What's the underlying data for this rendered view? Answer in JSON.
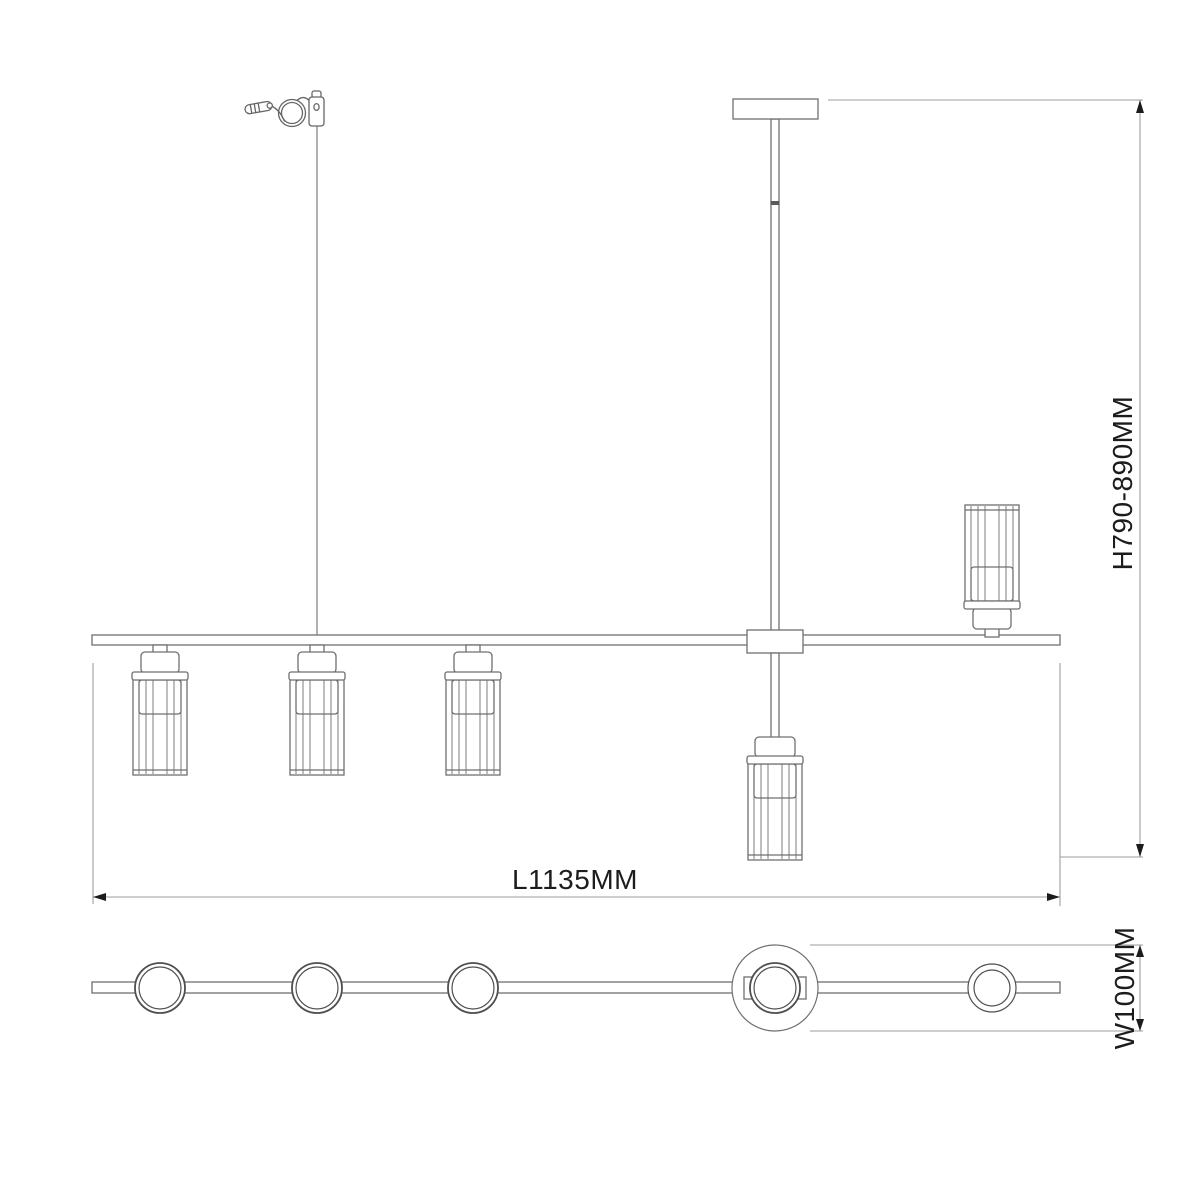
{
  "drawing": {
    "type": "lighting-fixture-dimension-drawing",
    "labels": {
      "height": "H790-890MM",
      "length": "L1135MM",
      "width": "W100MM"
    },
    "colors": {
      "background": "#ffffff",
      "structure_line": "#6f6f6f",
      "detail_line": "#4f4f4f",
      "dimension_line": "#9e9e9e",
      "text_and_arrows": "#1c1c1c"
    }
  }
}
